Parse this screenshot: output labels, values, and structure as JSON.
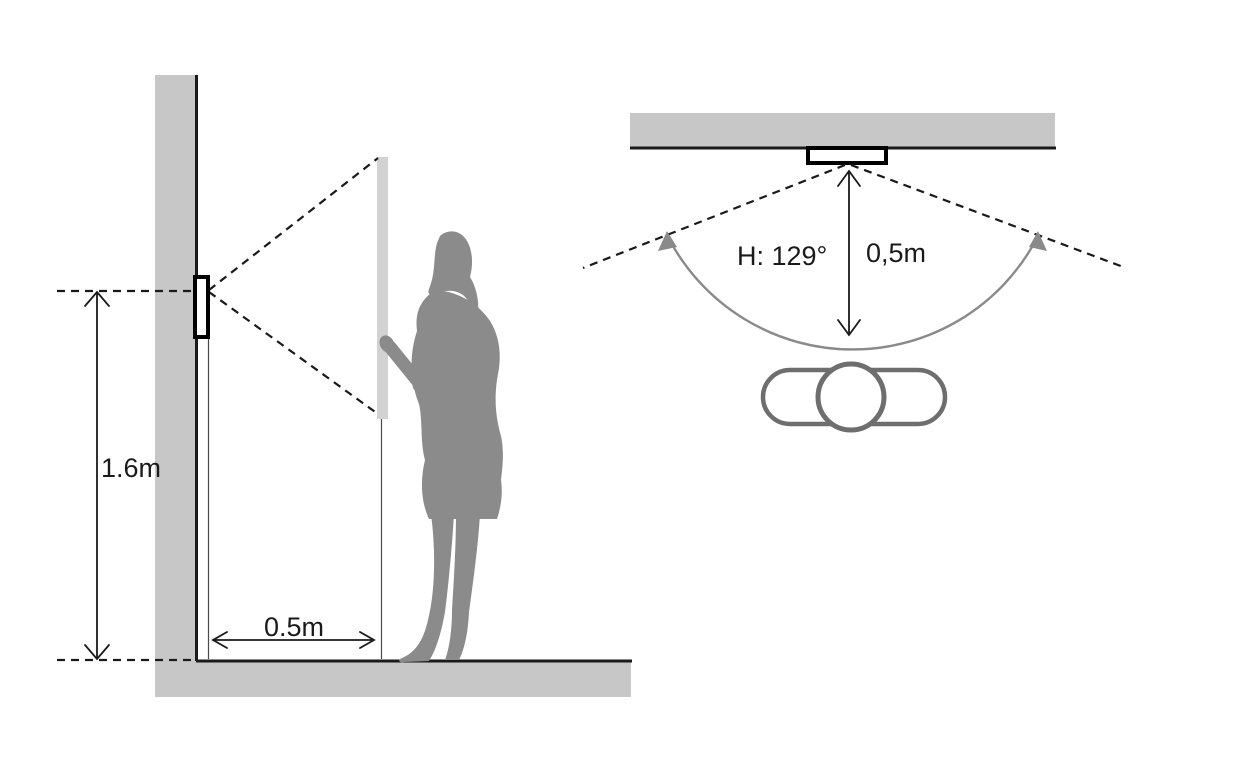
{
  "diagram": {
    "side_view": {
      "labels": {
        "mounting_height": "1.6m",
        "distance_from_wall": "0.5m"
      }
    },
    "top_view": {
      "labels": {
        "horizontal_fov": "H: 129°",
        "distance_from_wall": "0,5m"
      }
    },
    "colors": {
      "background": "#ffffff",
      "wall_fill": "#c7c7c7",
      "panel_fill": "#d2d2d2",
      "silhouette_fill": "#8b8b8b",
      "topview_outline": "#6e6e6e",
      "arc_gray": "#8a8a8a",
      "line_black": "#1a1a1a"
    }
  }
}
